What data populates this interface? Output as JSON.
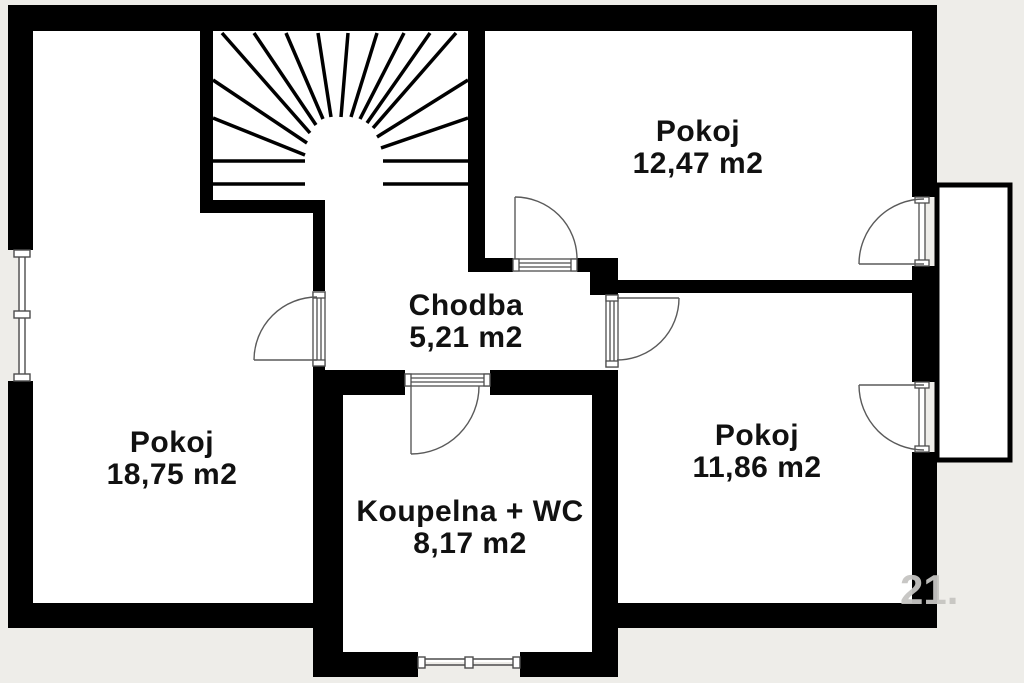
{
  "floorplan": {
    "rooms": [
      {
        "name": "Pokoj",
        "area": "12,47 m2"
      },
      {
        "name": "Chodba",
        "area": "5,21 m2"
      },
      {
        "name": "Pokoj",
        "area": "18,75 m2"
      },
      {
        "name": "Pokoj",
        "area": "11,86 m2"
      },
      {
        "name": "Koupelna + WC",
        "area": "8,17 m2"
      }
    ],
    "watermark": "21.",
    "colors": {
      "wall": "#000000",
      "floor": "#ffffff",
      "background": "#eeede9",
      "symbol_line": "#4d4d4d",
      "watermark": "#c6c5c2"
    },
    "features": [
      "staircase",
      "balcony",
      "windows",
      "doors"
    ]
  }
}
